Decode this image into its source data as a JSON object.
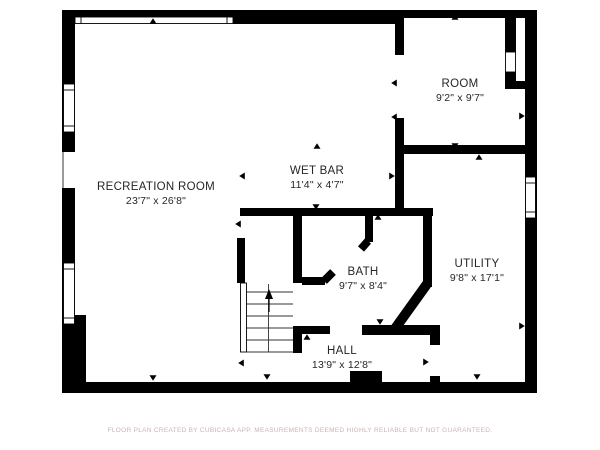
{
  "plan": {
    "rooms": [
      {
        "name": "RECREATION ROOM",
        "dims": "23'7\" x 26'8\""
      },
      {
        "name": "WET BAR",
        "dims": "11'4\" x 4'7\""
      },
      {
        "name": "ROOM",
        "dims": "9'2\" x 9'7\""
      },
      {
        "name": "BATH",
        "dims": "9'7\" x 8'4\""
      },
      {
        "name": "UTILITY",
        "dims": "9'8\" x 17'1\""
      },
      {
        "name": "HALL",
        "dims": "13'9\" x 12'8\""
      }
    ],
    "stairs": {
      "direction": "up",
      "treads": 6
    },
    "colors": {
      "wall": "#000000",
      "background": "#ffffff",
      "label": "#262626",
      "watermark": "#ccb3b3"
    },
    "watermark": "FLOOR PLAN CREATED BY CUBICASA APP. MEASUREMENTS DEEMED HIGHLY RELIABLE BUT NOT GUARANTEED."
  }
}
